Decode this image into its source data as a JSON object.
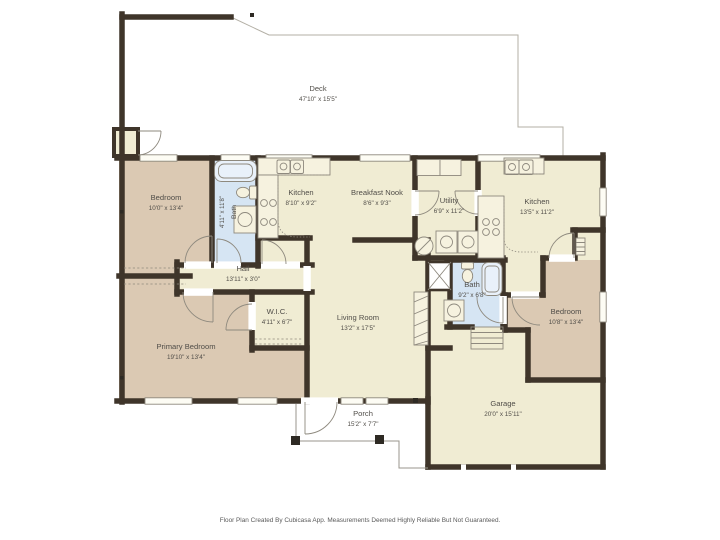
{
  "palette": {
    "wall_color": "#3f352a",
    "common_area_color": "#f0ecd3",
    "bedroom_color": "#dbc9b3",
    "bathroom_color": "#d6e5f3",
    "background_color": "#ffffff"
  },
  "rooms": {
    "deck": {
      "name": "Deck",
      "dims": "47'10\" x 15'5\""
    },
    "bedroom1": {
      "name": "Bedroom",
      "dims": "10'0\" x 13'4\""
    },
    "bath1": {
      "name": "Bath",
      "dims": "4'11\" x 11'8\""
    },
    "kitchen1": {
      "name": "Kitchen",
      "dims": "8'10\" x 9'2\""
    },
    "nook": {
      "name": "Breakfast Nook",
      "dims": "8'6\" x 9'3\""
    },
    "utility": {
      "name": "Utility",
      "dims": "6'9\" x 11'2\""
    },
    "kitchen2": {
      "name": "Kitchen",
      "dims": "13'5\" x 11'2\""
    },
    "hall": {
      "name": "Hall",
      "dims": "13'11\" x 3'0\""
    },
    "wic": {
      "name": "W.I.C.",
      "dims": "4'11\" x 6'7\""
    },
    "living": {
      "name": "Living Room",
      "dims": "13'2\" x 17'5\""
    },
    "bath2": {
      "name": "Bath",
      "dims": "9'2\" x 6'8\""
    },
    "primary": {
      "name": "Primary Bedroom",
      "dims": "19'10\" x 13'4\""
    },
    "bedroom2": {
      "name": "Bedroom",
      "dims": "10'8\" x 13'4\""
    },
    "porch": {
      "name": "Porch",
      "dims": "15'2\" x 7'7\""
    },
    "garage": {
      "name": "Garage",
      "dims": "20'0\" x 15'11\""
    }
  },
  "footer": {
    "disclaimer": "Floor Plan Created By Cubicasa App. Measurements Deemed Highly Reliable But Not Guaranteed."
  }
}
